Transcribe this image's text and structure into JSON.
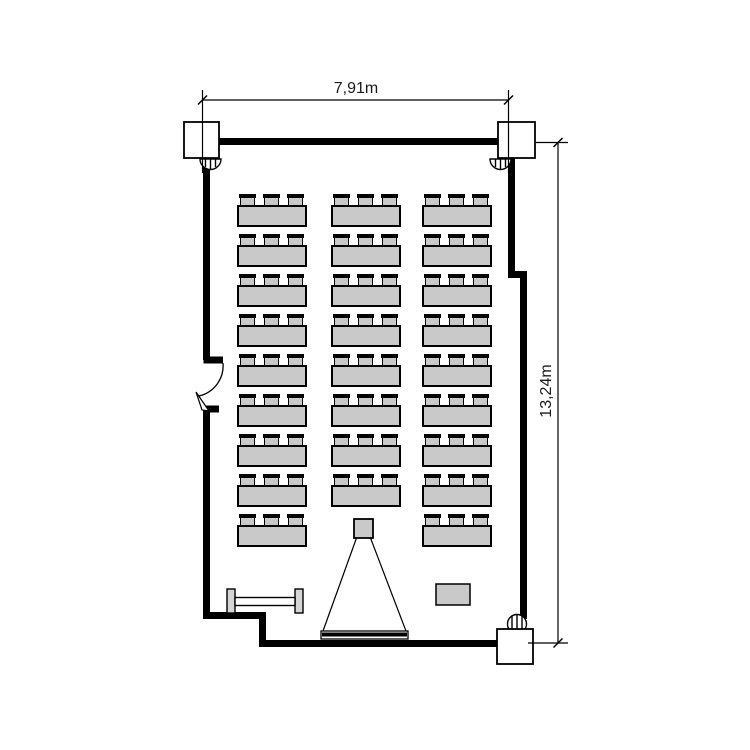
{
  "page": {
    "title": "Seminar room floor plan",
    "type": "architectural-floor-plan"
  },
  "dimensions": {
    "width_label": "7,91m",
    "height_label": "13,24m"
  },
  "colors": {
    "background": "#ffffff",
    "wall": "#000000",
    "furniture_fill": "#c9c9c9",
    "outline": "#000000"
  },
  "room": {
    "structural_columns": 3,
    "pipe_symbols": 3,
    "doors": 1
  },
  "furniture": {
    "desk_grid": {
      "rows": 9,
      "columns": 3,
      "col_x": [
        237,
        331,
        422
      ],
      "row_y": [
        205,
        245,
        285,
        325,
        365,
        405,
        445,
        485,
        525
      ],
      "table_width": 70,
      "table_height": 22,
      "chair_width": 17,
      "chair_height": 13,
      "chair_offsets": [
        2,
        26,
        50
      ],
      "chairs_per_desk": 3,
      "skip": [
        {
          "row": 8,
          "col": 1
        }
      ]
    },
    "desk_count": 26,
    "seat_count": 78,
    "equipment": {
      "projector": "projector",
      "screen": "projection-screen",
      "bench": "sideboard",
      "side_table": "side-table"
    }
  }
}
